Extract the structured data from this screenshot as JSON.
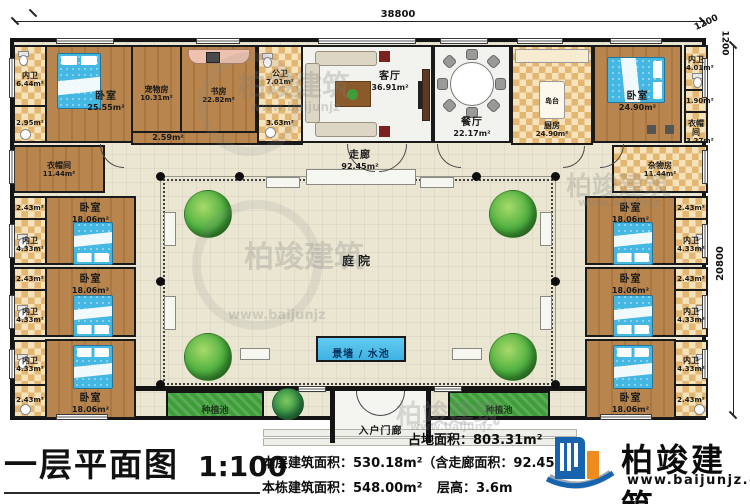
{
  "title": {
    "main": "一层平面图",
    "scale": "1:100"
  },
  "dims": {
    "width_top": "38800",
    "offset_a": "1200",
    "offset_b": "1200",
    "height_right": "20800"
  },
  "stats": {
    "land": "占地面积：803.31m²",
    "floor": "本层建筑面积：530.18m²（含走廊面积：92.45m²）",
    "building": "本栋建筑面积：548.00m²",
    "storey": "层高：3.6m"
  },
  "logo": {
    "name": "柏竣建筑",
    "url": "www.baijunjz.com"
  },
  "watermark": {
    "brand": "柏竣建筑",
    "url_short": "www.baijunjz"
  },
  "rooms": {
    "bath_nw": {
      "name": "内卫",
      "area": "6.44m²"
    },
    "small_295": {
      "area": "2.95m²"
    },
    "bedroom_master": {
      "name": "卧室",
      "area": "25.55m²"
    },
    "pet_room": {
      "name": "宠物房",
      "area": "10.31m²"
    },
    "strip_259": {
      "area": "2.59m²"
    },
    "study": {
      "name": "书房",
      "area": "22.82m²"
    },
    "bath_public": {
      "name": "公卫",
      "area": "7.01m²"
    },
    "small_363": {
      "area": "3.63m²"
    },
    "living": {
      "name": "客厅",
      "area": "36.91m²"
    },
    "dining": {
      "name": "餐厅",
      "area": "22.17m²"
    },
    "kitchen": {
      "name": "厨房",
      "area": "24.90m²"
    },
    "island": {
      "name": "岛台"
    },
    "bedroom_ne": {
      "name": "卧室",
      "area": "24.90m²"
    },
    "bath_ne": {
      "name": "内卫",
      "area": "4.01m²"
    },
    "small_190": {
      "area": "1.90m²"
    },
    "closet_ne": {
      "name": "衣帽间",
      "area": "3.27m²"
    },
    "closet_w": {
      "name": "衣帽间",
      "area": "11.44m²"
    },
    "storage_e": {
      "name": "杂物房",
      "area": "11.44m²"
    },
    "small_243": {
      "area": "2.43m²"
    },
    "bath_433": {
      "name": "内卫",
      "area": "4.33m²"
    },
    "bedroom_side": {
      "name": "卧室",
      "area": "18.06m²"
    },
    "corridor": {
      "name": "走廊",
      "area": "92.45m²"
    },
    "courtyard": {
      "name": "庭院"
    },
    "pool": {
      "name": "景墙 / 水池"
    },
    "porch": {
      "name": "入户门廊"
    },
    "planter": {
      "name": "种植池"
    }
  }
}
